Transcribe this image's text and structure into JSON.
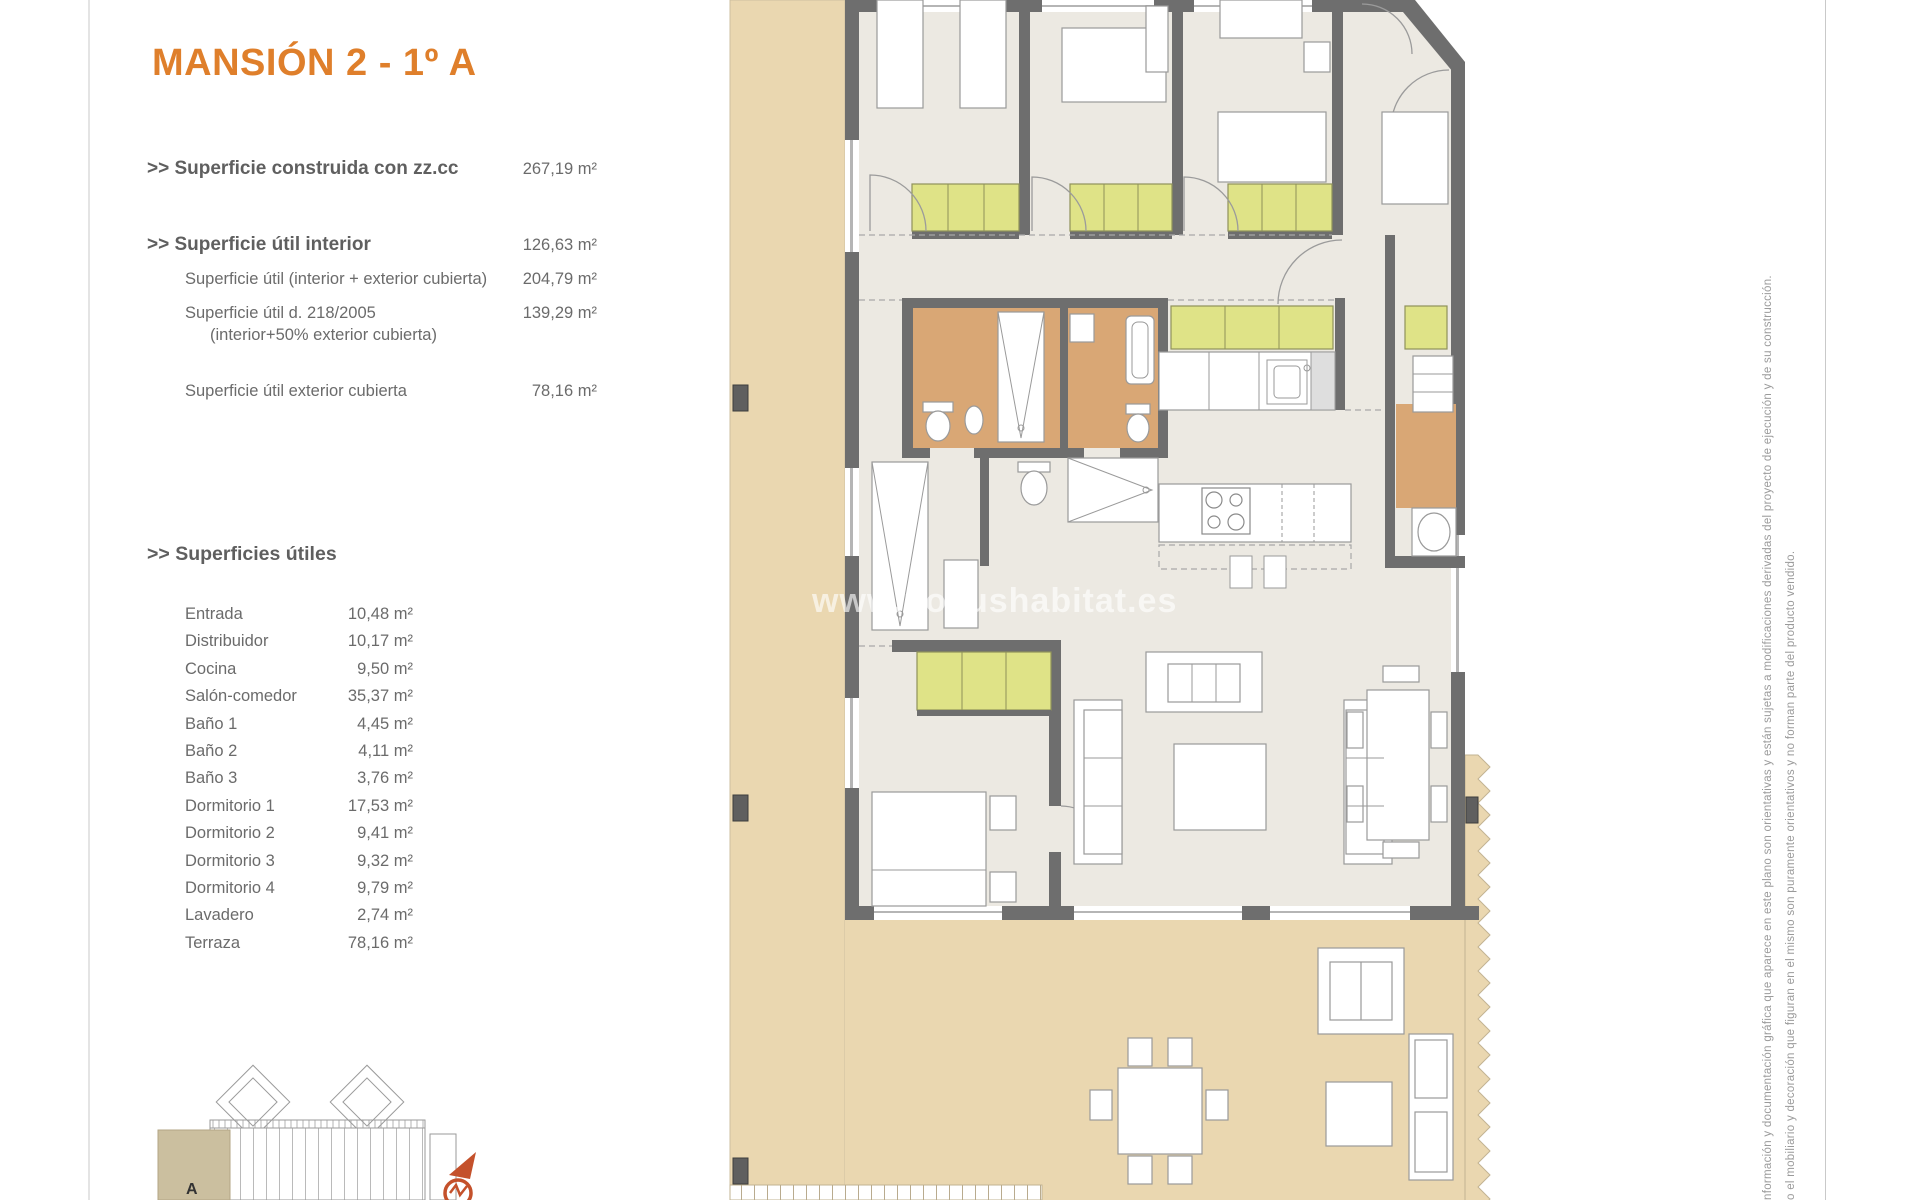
{
  "title": "MANSIÓN 2 - 1º A",
  "summary": {
    "rows": [
      {
        "label": ">> Superficie construida con zz.cc",
        "value": "267,19 m²"
      },
      {
        "label": ">> Superficie útil interior",
        "value": "126,63 m²"
      },
      {
        "label": "Superficie útil (interior + exterior cubierta)",
        "value": "204,79 m²"
      },
      {
        "label": "Superficie útil  d. 218/2005",
        "label2": "(interior+50% exterior cubierta)",
        "value": "139,29 m²"
      },
      {
        "label": "Superficie útil exterior cubierta",
        "value": "78,16 m²"
      }
    ]
  },
  "rooms": {
    "heading": ">> Superficies útiles",
    "rows": [
      {
        "label": "Entrada",
        "value": "10,48 m²"
      },
      {
        "label": "Distribuidor",
        "value": "10,17 m²"
      },
      {
        "label": "Cocina",
        "value": "9,50 m²"
      },
      {
        "label": "Salón-comedor",
        "value": "35,37 m²"
      },
      {
        "label": "Baño 1",
        "value": "4,45 m²"
      },
      {
        "label": "Baño 2",
        "value": "4,11 m²"
      },
      {
        "label": "Baño 3",
        "value": "3,76 m²"
      },
      {
        "label": "Dormitorio 1",
        "value": "17,53 m²"
      },
      {
        "label": "Dormitorio 2",
        "value": "9,41 m²"
      },
      {
        "label": "Dormitorio 3",
        "value": "9,32 m²"
      },
      {
        "label": "Dormitorio 4",
        "value": "9,79 m²"
      },
      {
        "label": "Lavadero",
        "value": "2,74 m²"
      },
      {
        "label": "Terraza",
        "value": "78,16 m²"
      }
    ]
  },
  "watermark": "www.novushabitat.es",
  "site_plan": {
    "unit_label": "A"
  },
  "disclaimer": {
    "line1": "nformación y documentación gráfica que aparece en este plano son orientativas y están sujetas a modificaciones derivadas del proyecto de ejecución y de su construcción.",
    "line2": "o el mobiliario y decoración que figuran en el mismo son puramente orientativos y no forman parte del producto vendido."
  },
  "colors": {
    "accent": "#DF7F2B",
    "terrace": "#EAD7B0",
    "wardrobe": "#DFE387",
    "bathroom": "#D9A775",
    "wall": "#6E6E6E",
    "floor": "#ECE9E2"
  }
}
